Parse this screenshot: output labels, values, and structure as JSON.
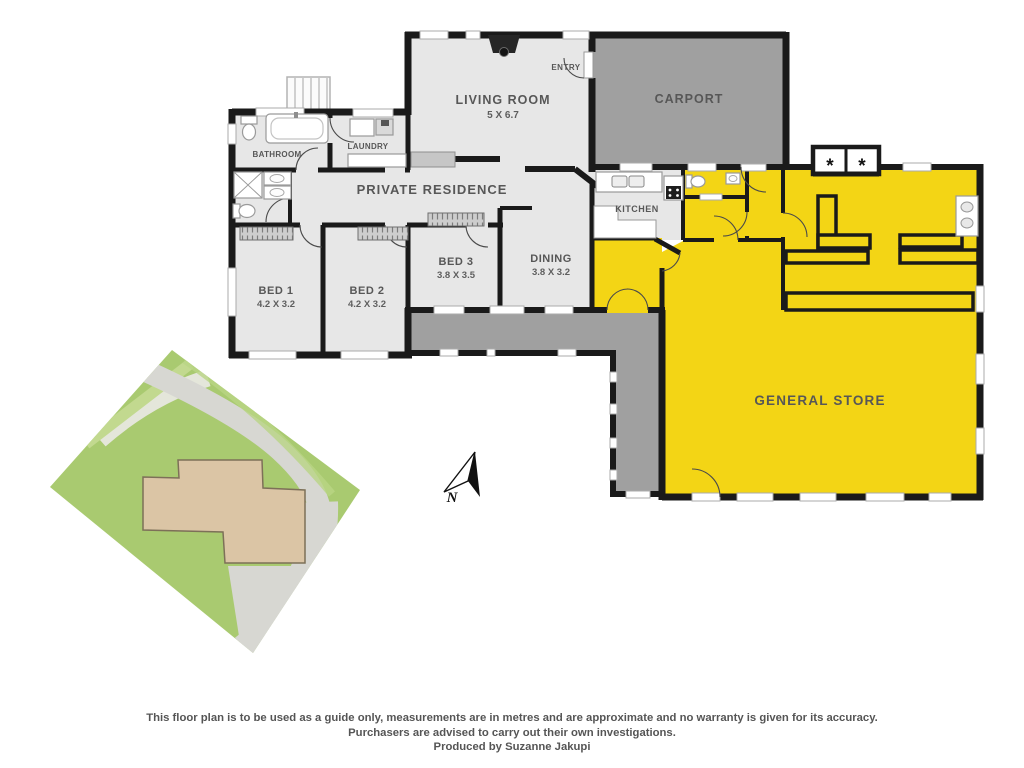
{
  "floorplan": {
    "residence_title": "PRIVATE RESIDENCE",
    "rooms": {
      "living": {
        "label": "LIVING ROOM",
        "dims": "5 X 6.7"
      },
      "entry": {
        "label": "ENTRY"
      },
      "carport": {
        "label": "CARPORT"
      },
      "bathroom": {
        "label": "BATHROOM"
      },
      "laundry": {
        "label": "LAUNDRY"
      },
      "kitchen": {
        "label": "KITCHEN"
      },
      "bed1": {
        "label": "BED 1",
        "dims": "4.2 X 3.2"
      },
      "bed2": {
        "label": "BED 2",
        "dims": "4.2 X 3.2"
      },
      "bed3": {
        "label": "BED 3",
        "dims": "3.8 X 3.5"
      },
      "dining": {
        "label": "DINING",
        "dims": "3.8 X 3.2"
      },
      "store": {
        "label": "GENERAL STORE"
      }
    },
    "markers": {
      "asterisk_left": "*",
      "asterisk_right": "*",
      "north": "N"
    },
    "colors": {
      "wall": "#1a1a1a",
      "residence_fill": "#e7e7e7",
      "carport_fill": "#a0a0a0",
      "verandah_fill": "#a0a0a0",
      "store_fill": "#f3d515",
      "label_gray": "#575757",
      "site_green": "#a9ca70",
      "site_path_gray": "#d7d7d2",
      "site_footprint": "#dbc5a5"
    }
  },
  "footer": {
    "line1": "This floor plan is to be used as a guide only, measurements are in metres and are approximate and no warranty is given for its accuracy.",
    "line2": "Purchasers are advised to carry out their own investigations.",
    "line3": "Produced by Suzanne Jakupi"
  }
}
